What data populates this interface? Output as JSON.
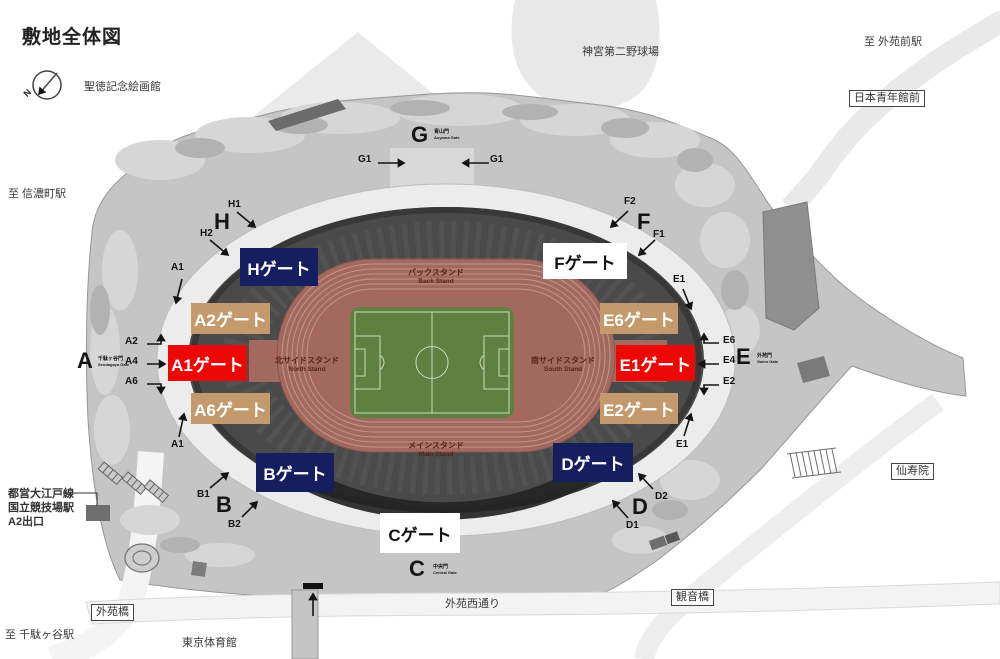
{
  "title": "敷地全体図",
  "colors": {
    "navy": "#151e5e",
    "red": "#ee0707",
    "tan": "#c49a6c",
    "white_box": "#ffffff",
    "track": "#a3695e",
    "field": "#5e8142",
    "site_gray": "#c5c5c5"
  },
  "compass": {
    "north": "N",
    "museum": "聖徳記念絵画館"
  },
  "landmarks": {
    "ballpark": "神宮第二野球場",
    "to_gaienmae": "至 外苑前駅",
    "seinenkan": "日本青年館前",
    "to_shinanomachi": "至 信濃町駅",
    "station_line1": "都営大江戸線",
    "station_line2": "国立競技場駅",
    "station_line3": "A2出口",
    "gaien_bridge": "外苑橋",
    "to_sendagaya": "至 千駄ヶ谷駅",
    "tokyo_gym": "東京体育館",
    "gaien_nishi": "外苑西通り",
    "kannon_bridge": "観音橋",
    "senjuin": "仙寿院"
  },
  "stands": {
    "back_jp": "バックスタンド",
    "back_en": "Back Stand",
    "north_jp": "北サイドスタンド",
    "north_en": "North Stand",
    "south_jp": "南サイドスタンド",
    "south_en": "South Stand",
    "main_jp": "メインスタンド",
    "main_en": "Main Stand"
  },
  "gates": {
    "h": "Hゲート",
    "f": "Fゲート",
    "a2": "A2ゲート",
    "e6": "E6ゲート",
    "a1": "A1ゲート",
    "e1": "E1ゲート",
    "a6": "A6ゲート",
    "e2": "E2ゲート",
    "b": "Bゲート",
    "d": "Dゲート",
    "c": "Cゲート"
  },
  "gate_letters": {
    "g": "G",
    "h": "H",
    "f": "F",
    "a": "A",
    "e": "E",
    "b": "B",
    "c": "C",
    "d": "D"
  },
  "gate_names": {
    "g_jp": "青山門",
    "g_en": "Aoyama Gate",
    "a_jp": "千駄ヶ谷門",
    "a_en": "Sendagaya Gate",
    "e_jp": "外苑門",
    "e_en": "Gaien Gate",
    "c_jp": "中央門",
    "c_en": "Central Gate"
  },
  "markers": {
    "g1_left": "G1",
    "g1_right": "G1",
    "h1": "H1",
    "h2": "H2",
    "f2": "F2",
    "f1": "F1",
    "a1_top": "A1",
    "a2": "A2",
    "a4": "A4",
    "a6": "A6",
    "a1_bottom": "A1",
    "e1_top": "E1",
    "e6": "E6",
    "e4": "E4",
    "e2": "E2",
    "e1_bottom": "E1",
    "b1": "B1",
    "b2": "B2",
    "d2": "D2",
    "d1": "D1"
  }
}
